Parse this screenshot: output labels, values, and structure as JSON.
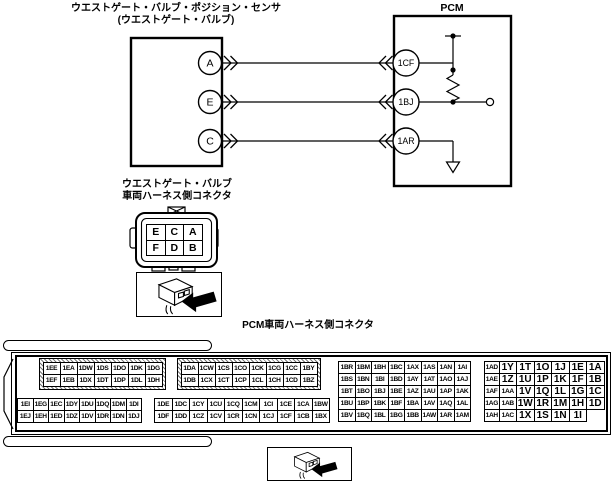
{
  "colors": {
    "line": "#000000",
    "background": "#ffffff"
  },
  "labels": {
    "sensor_line1": "ウエストゲート・バルブ・ポジション・センサ",
    "sensor_line2": "(ウエストゲート・バルブ)",
    "pcm": "PCM"
  },
  "diagram": {
    "component_terminals": [
      "A",
      "E",
      "C"
    ],
    "pcm_terminals": [
      "1CF",
      "1BJ",
      "1AR"
    ]
  },
  "harness_connector": {
    "label_line1": "ウエストゲート・バルブ",
    "label_line2": "車両ハーネス側コネクタ",
    "grid": [
      [
        "E",
        "C",
        "A"
      ],
      [
        "F",
        "D",
        "B"
      ]
    ],
    "view_icon": "connector-3d-arrow-icon"
  },
  "pcm_connector": {
    "title": "PCM車両ハーネス側コネクタ",
    "view_icon": "connector-3d-arrow-icon",
    "blocks": {
      "upper_left": [
        [
          "1EE",
          "1EA",
          "1DW",
          "1DS",
          "1DO",
          "1DK",
          "1DG"
        ],
        [
          "1EF",
          "1EB",
          "1DX",
          "1DT",
          "1DP",
          "1DL",
          "1DH"
        ]
      ],
      "upper_mid": [
        [
          "1DA",
          "1CW",
          "1CS",
          "1CO",
          "1CK",
          "1CG",
          "1CC",
          "1BY"
        ],
        [
          "1DB",
          "1CX",
          "1CT",
          "1CP",
          "1CL",
          "1CH",
          "1CD",
          "1BZ"
        ]
      ],
      "lower_left": [
        [
          "1EI",
          "1EG",
          "1EC",
          "1DY",
          "1DU",
          "1DQ",
          "1DM",
          "1DI"
        ],
        [
          "1EJ",
          "1EH",
          "1ED",
          "1DZ",
          "1DV",
          "1DR",
          "1DN",
          "1DJ"
        ]
      ],
      "lower_mid": [
        [
          "1DE",
          "1DC",
          "1CY",
          "1CU",
          "1CQ",
          "1CM",
          "1CI",
          "1CE",
          "1CA",
          "1BW"
        ],
        [
          "1DF",
          "1DD",
          "1CZ",
          "1CV",
          "1CR",
          "1CN",
          "1CJ",
          "1CF",
          "1CB",
          "1BX"
        ]
      ],
      "right_a": [
        [
          "1BR",
          "1BM",
          "1BH",
          "1BC",
          "1AX",
          "1AS",
          "1AN",
          "1AI"
        ],
        [
          "1BS",
          "1BN",
          "1BI",
          "1BD",
          "1AY",
          "1AT",
          "1AO",
          "1AJ"
        ],
        [
          "1BT",
          "1BO",
          "1BJ",
          "1BE",
          "1AZ",
          "1AU",
          "1AP",
          "1AK"
        ],
        [
          "1BU",
          "1BP",
          "1BK",
          "1BF",
          "1BA",
          "1AV",
          "1AQ",
          "1AL"
        ],
        [
          "1BV",
          "1BQ",
          "1BL",
          "1BG",
          "1BB",
          "1AW",
          "1AR",
          "1AM"
        ]
      ],
      "right_b": [
        [
          "1AD",
          "1Y",
          "1T",
          "1O",
          "1J",
          "1E",
          "1A"
        ],
        [
          "1AE",
          "1Z",
          "1U",
          "1P",
          "1K",
          "1F",
          "1B"
        ],
        [
          "1AF",
          "1AA",
          "1V",
          "1Q",
          "1L",
          "1G",
          "1C"
        ],
        [
          "1AG",
          "1AB",
          "1W",
          "1R",
          "1M",
          "1H",
          "1D"
        ],
        [
          "1AH",
          "1AC",
          "1X",
          "1S",
          "1N",
          "1I"
        ]
      ]
    }
  }
}
